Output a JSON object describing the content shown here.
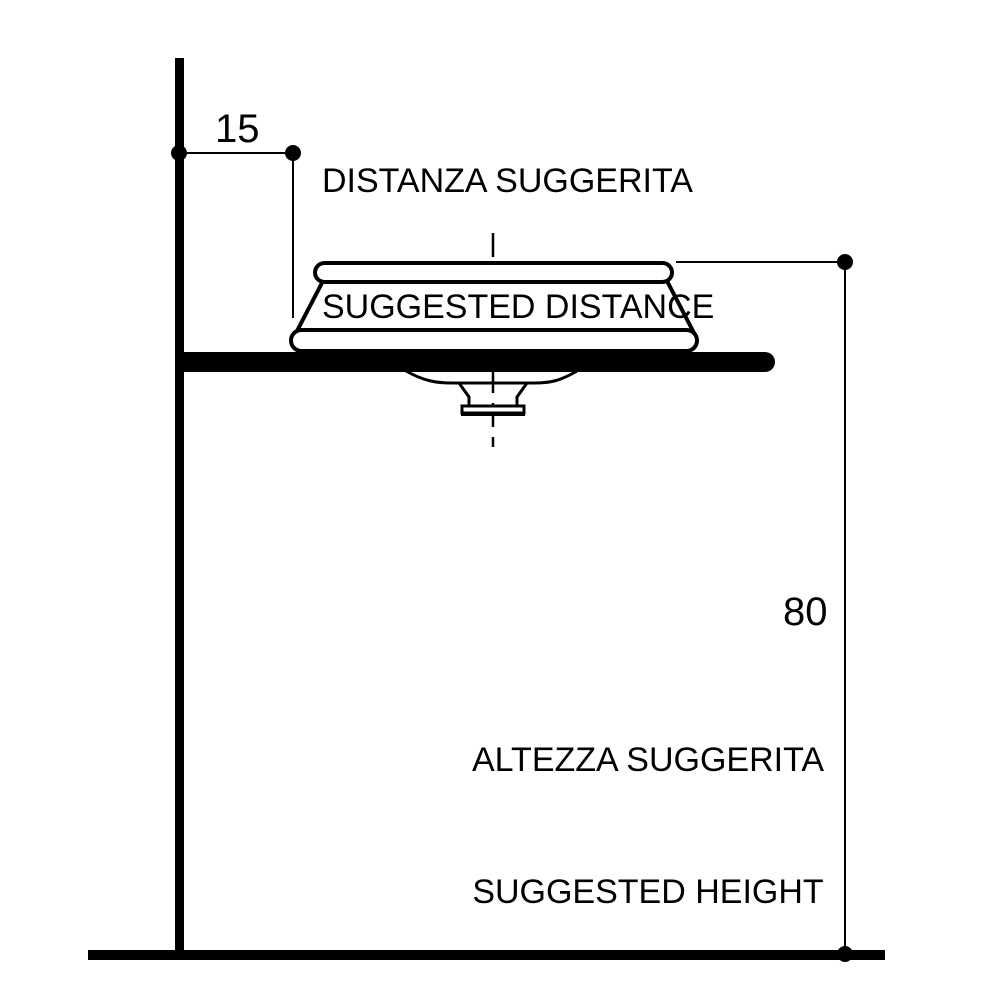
{
  "colors": {
    "ink": "#000000",
    "paper": "#ffffff"
  },
  "dimensions": {
    "distance": {
      "value": "15",
      "label_it": "DISTANZA SUGGERITA",
      "label_en": "SUGGESTED DISTANCE"
    },
    "height": {
      "value": "80",
      "label_it": "ALTEZZA SUGGERITA",
      "label_en": "SUGGESTED HEIGHT"
    }
  }
}
